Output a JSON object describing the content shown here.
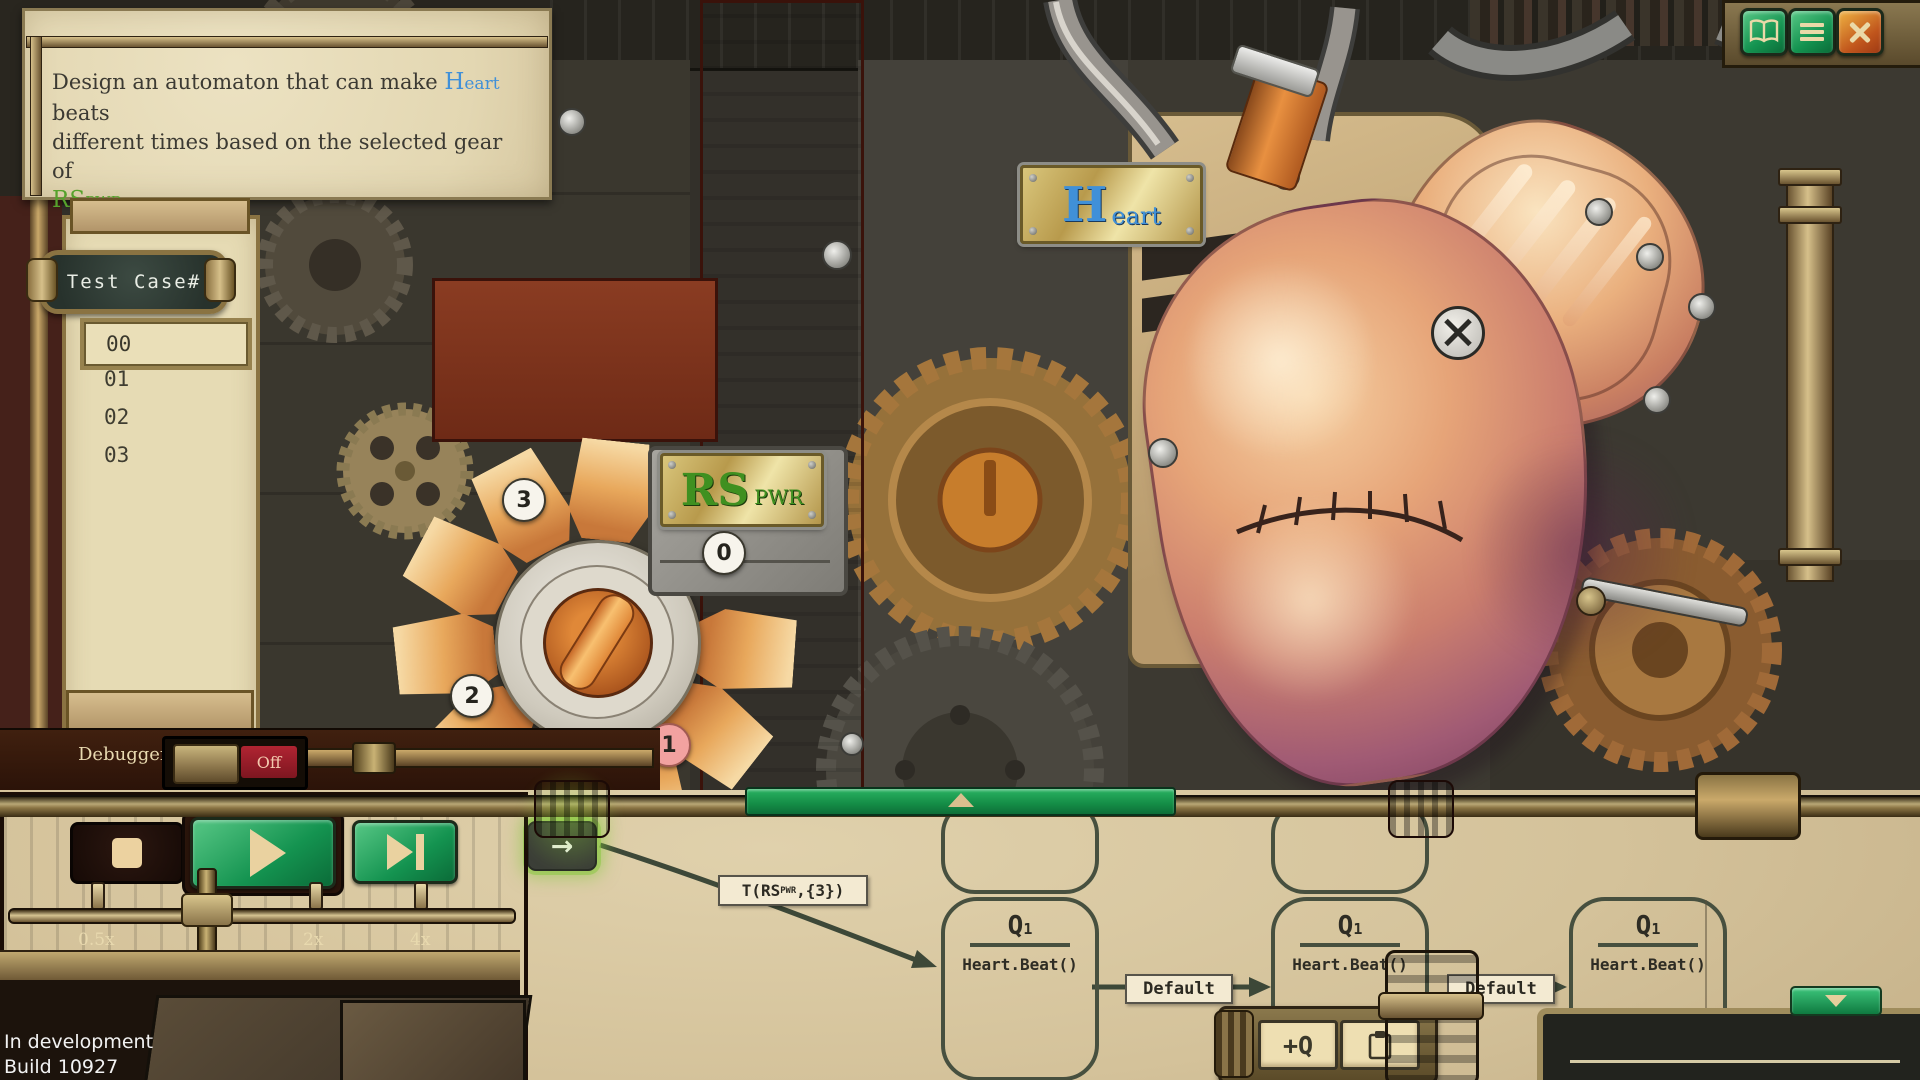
{
  "titlebar": {
    "help_icon": "open-book",
    "menu_icon": "hamburger",
    "close_icon": "x-cross"
  },
  "task_panel": {
    "line1_before": "Design an automaton that can make ",
    "heart_cap": "H",
    "heart_rest": "eart",
    "line1_after": " beats",
    "line2": "different times based on the selected gear of",
    "rs_cap": "RS",
    "rs_sub": "PWR"
  },
  "test_cases": {
    "title": "Test Case#",
    "rows": [
      "00",
      "01",
      "02",
      "03"
    ],
    "selected_row": "00"
  },
  "dial": {
    "plate_cap": "RS",
    "plate_sub": "PWR",
    "positions": [
      "3",
      "0",
      "2",
      "1"
    ],
    "active_position": "1"
  },
  "heart_plate": {
    "cap": "H",
    "rest": "eart"
  },
  "debugger": {
    "label": "Debugger",
    "state": "Off"
  },
  "speed": {
    "labels": [
      "0.5x",
      "1x",
      "2x",
      "4x"
    ],
    "current": "1x"
  },
  "statechart": {
    "start_arrow": "→",
    "transition_prefix": "T(RS",
    "transition_sub": "PWR",
    "transition_suffix": ",{3})",
    "default_label": "Default",
    "states": [
      {
        "name": "Q",
        "sub": "1",
        "action": "Heart.Beat()"
      },
      {
        "name": "Q",
        "sub": "1",
        "action": "Heart.Beat()"
      },
      {
        "name": "Q",
        "sub": "1",
        "action": "Heart.Beat()"
      }
    ],
    "add_state_label": "+Q"
  },
  "footer": {
    "line1": "In development",
    "line2": "Build 10927"
  },
  "colors": {
    "button_green": "#129250",
    "close_orange": "#c0551c",
    "bar_green": "#1c9a4c",
    "toggle_red": "#9e2030",
    "rs_green": "#56a22c",
    "heart_blue": "#4090d8",
    "parchment": "#d9c8a2"
  }
}
